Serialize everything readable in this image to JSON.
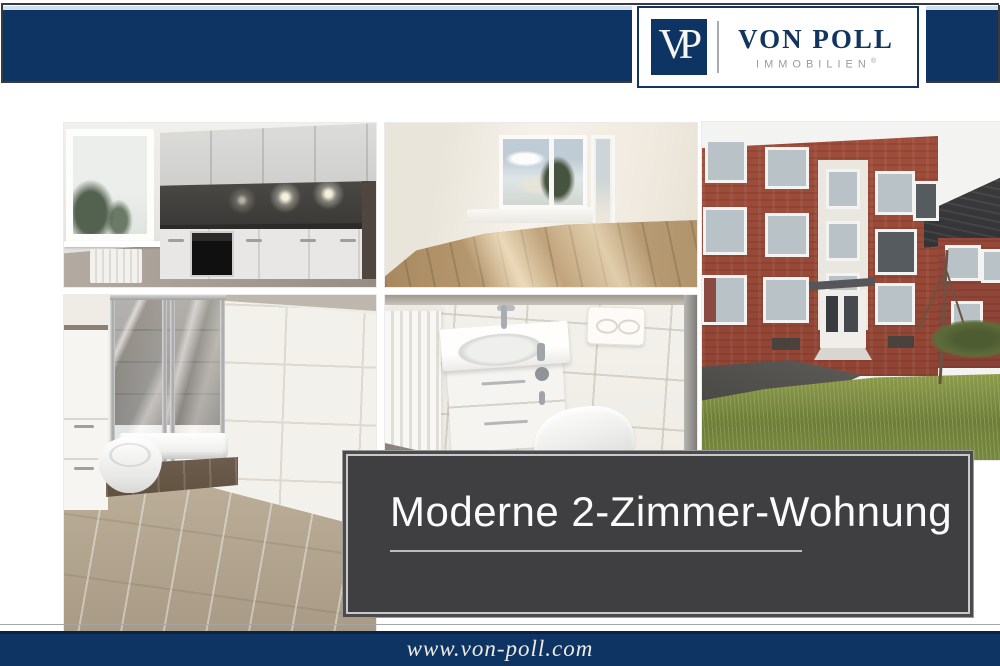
{
  "header": {
    "logo": {
      "monogram": "VP",
      "name": "VON POLL",
      "subtitle": "IMMOBILIEN",
      "registered": "®"
    }
  },
  "title_plate": {
    "text": "Moderne 2-Zimmer-Wohnung"
  },
  "footer": {
    "website": "www.von-poll.com"
  },
  "colors": {
    "brand_navy": "#0d3462",
    "accent_light_blue": "#cfe1ef",
    "title_plate_background": "#3f3f41",
    "title_plate_text": "#fbfbfb"
  },
  "photos": [
    {
      "id": "kitchen",
      "label": "modern white fitted kitchen with dark backsplash"
    },
    {
      "id": "living-room",
      "label": "empty living room with wood floor and window"
    },
    {
      "id": "building-exterior",
      "label": "red brick apartment building with lawn"
    },
    {
      "id": "shower-bathroom",
      "label": "bathroom with glass shower cabin"
    },
    {
      "id": "vanity-bathroom",
      "label": "bathroom with vanity sink and wall-hung toilet"
    }
  ]
}
